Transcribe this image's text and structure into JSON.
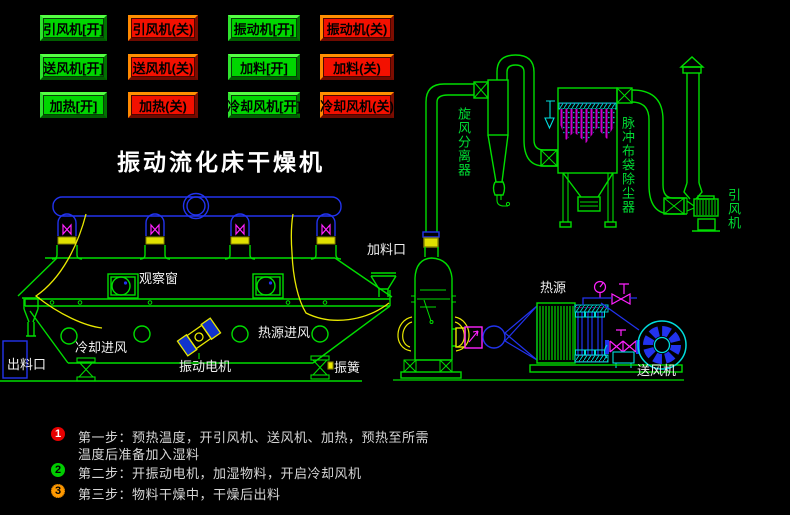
{
  "title": "振动流化床干燥机",
  "control_panel": {
    "buttons": [
      {
        "label": "引风机[开]",
        "action": "on"
      },
      {
        "label": "引风机(关)",
        "action": "off"
      },
      {
        "label": "振动机[开]",
        "action": "on"
      },
      {
        "label": "振动机(关)",
        "action": "off"
      },
      {
        "label": "送风机[开]",
        "action": "on"
      },
      {
        "label": "送风机(关)",
        "action": "off"
      },
      {
        "label": "加料[开]",
        "action": "on"
      },
      {
        "label": "加料(关)",
        "action": "off"
      },
      {
        "label": "加热[开]",
        "action": "on"
      },
      {
        "label": "加热(关)",
        "action": "off"
      },
      {
        "label": "冷却风机[开]",
        "action": "on"
      },
      {
        "label": "冷却风机(关)",
        "action": "off"
      }
    ]
  },
  "diagram": {
    "labels": {
      "cyclone_separator": "旋风分离器",
      "pulse_bag_dust_collector": "脉冲布袋除尘器",
      "induced_draft_fan": "引风机",
      "feed_inlet": "加料口",
      "observation_window": "观察窗",
      "cooling_air_inlet": "冷却进风",
      "discharge_outlet": "出料口",
      "vibration_motor": "振动电机",
      "heat_source_air_inlet": "热源进风",
      "vibration_spring": "振簧",
      "heat_source": "热源",
      "supply_fan": "送风机"
    }
  },
  "steps": [
    {
      "num": "1",
      "lines": [
        "第一步：预热温度，开引风机、送风机、加热，预热至所需",
        "温度后准备加入湿料"
      ]
    },
    {
      "num": "2",
      "lines": [
        "第二步：开振动电机，加湿物料，开启冷却风机"
      ]
    },
    {
      "num": "3",
      "lines": [
        "第三步：物料干燥中，干燥后出料"
      ]
    }
  ],
  "colors": {
    "background": "#000000",
    "line_green": "#00dd00",
    "line_blue": "#2233ee",
    "line_yellow": "#e8e800",
    "line_magenta": "#ff22ff",
    "line_cyan": "#00dddd",
    "button_on": "#00d600",
    "button_off": "#f31000",
    "step1_badge": "#e60000",
    "step2_badge": "#00cc00",
    "step3_badge": "#ff9900"
  }
}
